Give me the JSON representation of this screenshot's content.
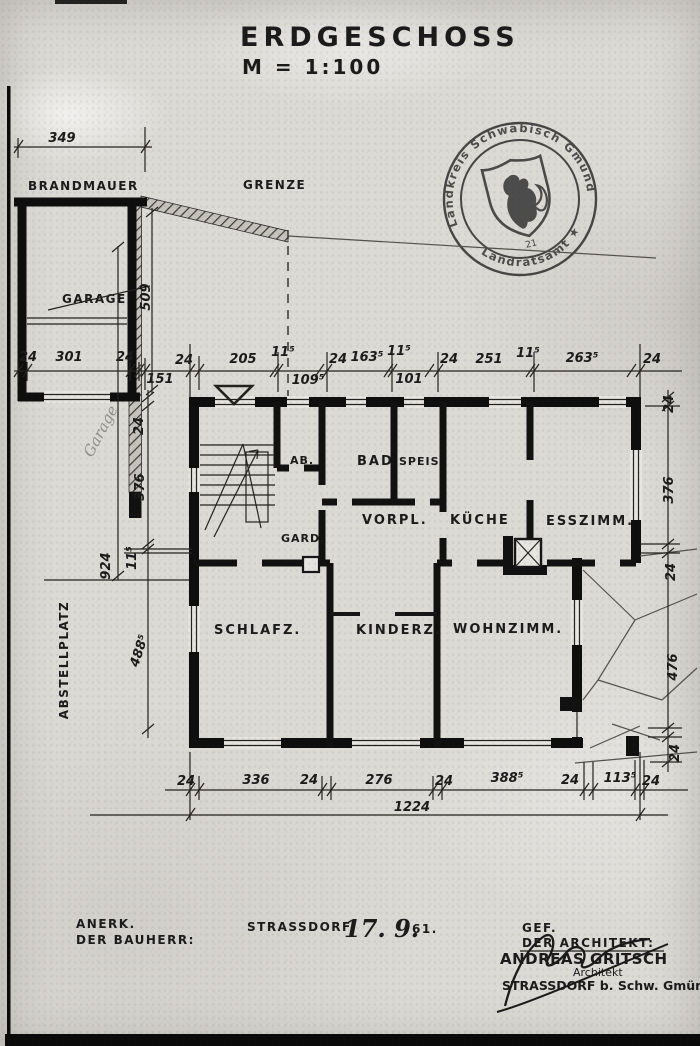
{
  "title": {
    "main": "ERDGESCHOSS",
    "scale": "M = 1:100"
  },
  "stamp": {
    "arc_top": "Landkreis Schwäbisch Gmünd",
    "arc_bottom": "Landratsamt ★",
    "number": "21"
  },
  "site": {
    "brandmauer": "BRANDMAUER",
    "grenze": "GRENZE",
    "garage": "GARAGE",
    "garage_pencil": "Garage",
    "abstellplatz": "ABSTELLPLATZ"
  },
  "rooms": {
    "ab": "AB.",
    "bad": "BAD",
    "speis": "SPEIS",
    "vorpl": "VORPL.",
    "gard": "GARD.",
    "kueche": "KÜCHE",
    "esszimm": "ESSZIMM.",
    "schlafz": "SCHLAFZ.",
    "kinderz": "KINDERZ.",
    "wohnzimm": "WOHNZIMM."
  },
  "dims": {
    "garage_width": "349",
    "garage_row": [
      "24",
      "301",
      "24"
    ],
    "offset": "151",
    "boundary": "509",
    "top_row": [
      "24",
      "205",
      "11⁵",
      "109⁵",
      "24",
      "163⁵",
      "11⁵",
      "101",
      "24",
      "251",
      "11⁵",
      "263⁵",
      "24"
    ],
    "bottom_row": [
      "24",
      "336",
      "24",
      "276",
      "24",
      "388⁵",
      "24",
      "113⁵",
      "24"
    ],
    "total": "1224",
    "left": [
      "24",
      "376",
      "11⁵",
      "924",
      "488⁵"
    ],
    "right": [
      "24",
      "376",
      "24",
      "476",
      "24"
    ]
  },
  "footer": {
    "anerk1": "ANERK.",
    "anerk2": "DER BAUHERR:",
    "place": "STRASSDORF,",
    "date": "17. 9.",
    "year": "61.",
    "gef1": "GEF.",
    "gef2": "DER ARCHITEKT:",
    "arch_name": "ANDREAS GRITSCH",
    "arch_title": "Architekt",
    "arch_place": "STRASSDORF b. Schw. Gmünd"
  }
}
